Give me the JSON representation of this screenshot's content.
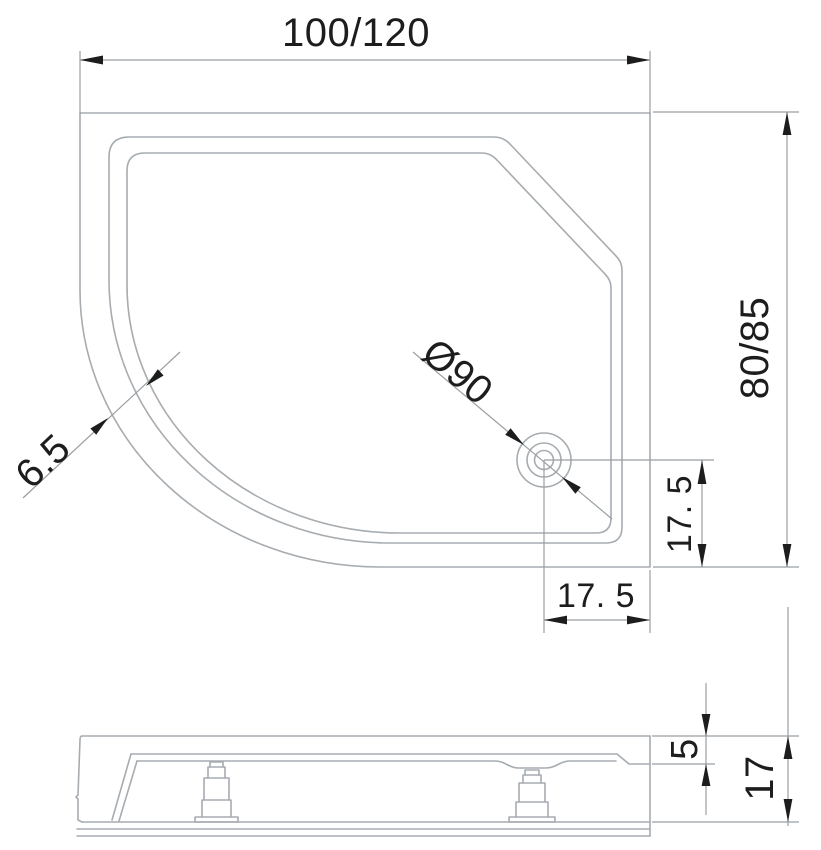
{
  "colors": {
    "background": "#ffffff",
    "drawing_line": "#a7acb0",
    "dim_line": "#999fa3",
    "ink": "#1d1d1d"
  },
  "drawing": {
    "type": "shower-tray-technical-drawing",
    "dim_labels": {
      "width": "100/120",
      "depth": "80/85",
      "drain_diameter": "Ø90",
      "drain_offset_bottom": "17. 5",
      "drain_offset_right": "17. 5",
      "corner_rim_width": "6.5",
      "rim_height": "5",
      "total_height": "17"
    }
  }
}
